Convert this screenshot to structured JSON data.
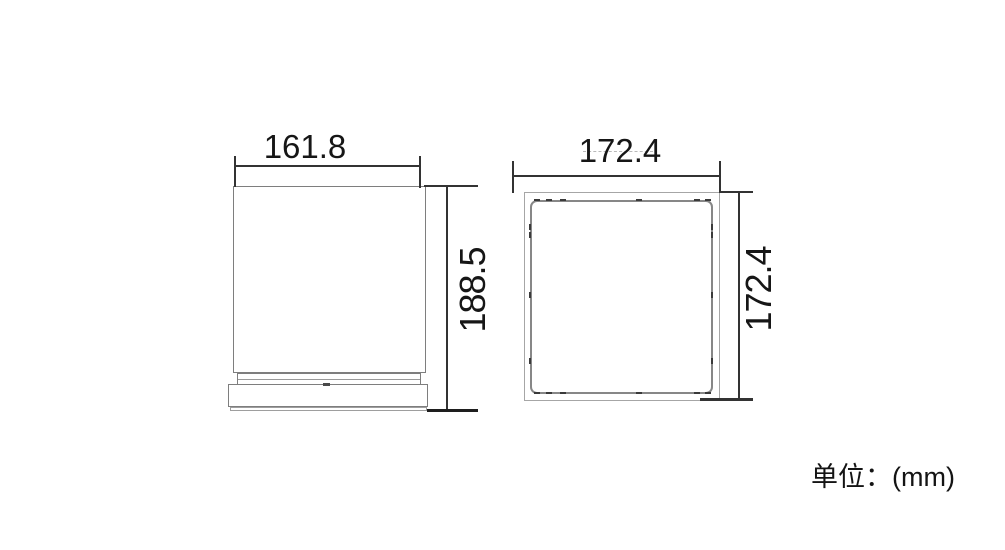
{
  "unit_label": "单位：(mm)",
  "views": {
    "front": {
      "width_label": "161.8",
      "height_label": "188.5"
    },
    "panel": {
      "width_label": "172.4",
      "height_label": "172.4"
    }
  },
  "dimensions_mm": {
    "front_width": 161.8,
    "front_height": 188.5,
    "panel_width": 172.4,
    "panel_height": 172.4
  },
  "colors": {
    "background": "#ffffff",
    "object_line": "#7e7e7e",
    "object_line_light": "#a6a6a6",
    "dimension_line": "#333333",
    "text": "#161616"
  }
}
